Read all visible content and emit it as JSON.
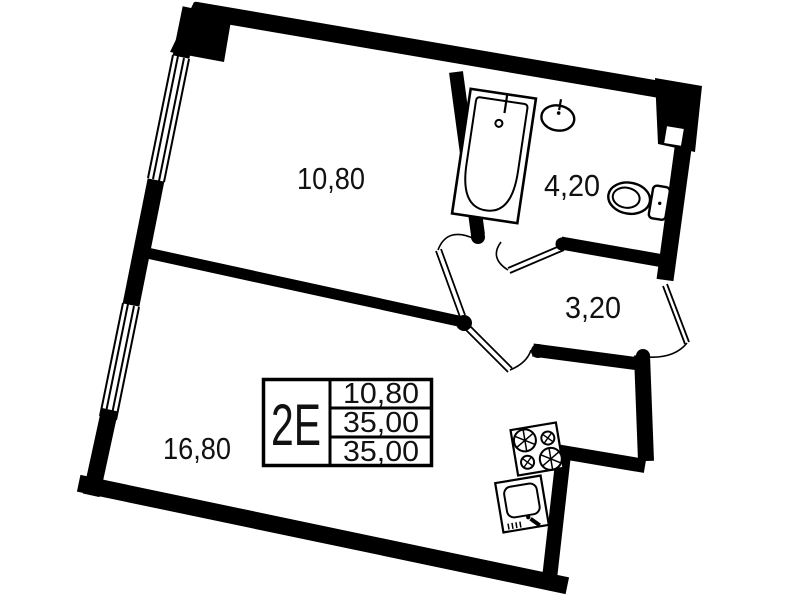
{
  "title": "apartment floor plan",
  "colors": {
    "walls": "#000000",
    "background": "#ffffff",
    "text": "#111111"
  },
  "rooms": [
    {
      "name": "room",
      "area": "10,80"
    },
    {
      "name": "bathroom",
      "area": "4,20"
    },
    {
      "name": "hallway",
      "area": "3,20"
    },
    {
      "name": "kitchen-living-room",
      "area": "16,80"
    }
  ],
  "info_table": {
    "unit_label": "2E",
    "rows": [
      {
        "value": "10,80"
      },
      {
        "value": "35,00"
      },
      {
        "value": "35,00"
      }
    ]
  },
  "fixtures": [
    "bathtub",
    "wash-basin",
    "toilet",
    "stove",
    "kitchen-sink",
    "window",
    "door-swing"
  ]
}
